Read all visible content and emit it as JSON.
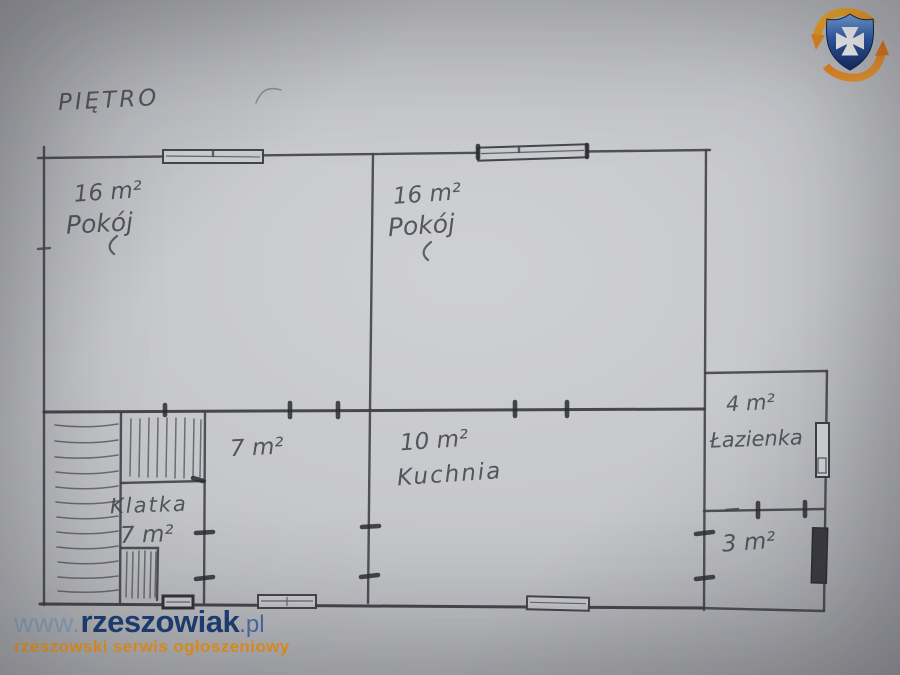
{
  "photo": {
    "floor_label": "PIĘTRO",
    "rooms": [
      {
        "area": "16 m²",
        "name": "Pokój"
      },
      {
        "area": "16 m²",
        "name": "Pokój"
      },
      {
        "area": "7 m²",
        "name": ""
      },
      {
        "area": "10 m²",
        "name": "Kuchnia"
      },
      {
        "name": "Klatka",
        "area": "7 m²"
      },
      {
        "area": "4 m²",
        "name": "Łazienka"
      },
      {
        "area": "3 m²",
        "name": ""
      }
    ]
  },
  "watermark": {
    "url_prefix": "www.",
    "brand": "rzeszowiak",
    "url_suffix": ".pl",
    "tagline": "rzeszowski serwis ogłoszeniowy",
    "colors": {
      "url_prefix": "#8CA5C2",
      "brand": "#1D3E76",
      "url_suffix": "#4C6FA9",
      "tagline": "#F59C1D"
    }
  },
  "logo": {
    "name": "rzeszowiak-shield-logo",
    "shield_blue": "#2B55A8",
    "cross_white": "#FFFFFF",
    "arrow_orange": "#EF8E1E"
  }
}
